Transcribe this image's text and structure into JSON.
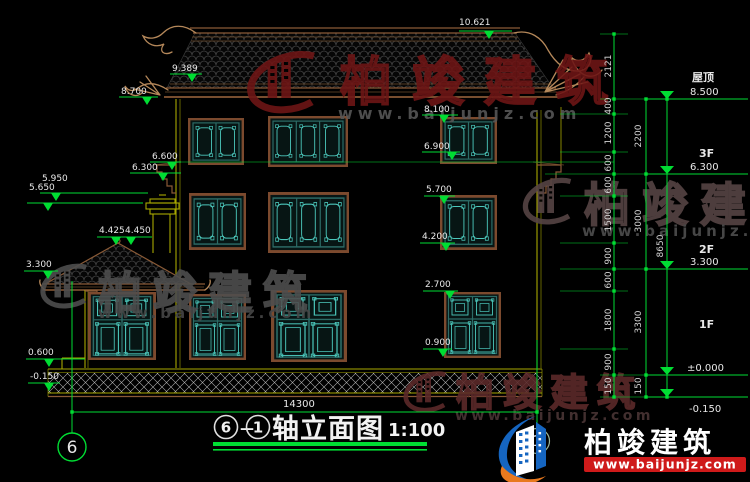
{
  "colors": {
    "bg": "#000000",
    "green": "#00dd33",
    "txt": "#e8e8e8",
    "wall": "#a8a800",
    "brown": "#8a5a36",
    "tan": "#b5885a",
    "teal": "#4cc8bc",
    "tealdark": "#2c6b66",
    "winbg": "#071514",
    "framebrown": "#7c4a2e",
    "wmred": "#6e1616",
    "wmgray": "#4f4f4f",
    "hatch": "#b5b5b5",
    "logoblue": "#1565c0",
    "logoorange": "#e8791e",
    "logored": "#cf1a1a"
  },
  "annotations": {
    "ridge": "10.621",
    "eave_top": "9.389",
    "eave_tip": "8.700",
    "wall_top": "8.100",
    "f3_sill": "6.900",
    "corbel_top": "6.600",
    "corbel_bot": "6.300",
    "chimney_cap": "5.950",
    "chimney_base": "5.650",
    "f2_head": "5.700",
    "f2_sill": "4.200",
    "annex_ridge_a": "4.425",
    "annex_ridge_b": "4.450",
    "annex_eave": "3.300",
    "f1_head": "2.700",
    "f1_sill": "0.900",
    "plinth": "0.600",
    "ground_left": "-0.150"
  },
  "chains": {
    "c1": [
      "2121",
      "400",
      "1200",
      "600",
      "600",
      "1500",
      "900",
      "600",
      "1800",
      "900",
      "150"
    ],
    "c2": [
      "2200",
      "3000",
      "3300",
      "150"
    ],
    "c3": [
      "8650"
    ]
  },
  "floors": [
    {
      "name": "屋顶",
      "elev": "8.500"
    },
    {
      "name": "3F",
      "elev": "6.300"
    },
    {
      "name": "2F",
      "elev": "3.300"
    },
    {
      "name": "1F",
      "elev": "±0.000"
    },
    {
      "name": "",
      "elev": "-0.150"
    }
  ],
  "grid": {
    "left": "6",
    "right": "1",
    "width_dim": "14300"
  },
  "title": {
    "start": "6",
    "dash": "—",
    "end": "1",
    "name": "轴立面图",
    "scale": "1:100"
  },
  "watermark": {
    "brand": "柏竣建筑",
    "url": "www.baijunjz.com"
  },
  "logo": {
    "brand": "柏竣建筑",
    "url": "www.baijunjz.com"
  }
}
